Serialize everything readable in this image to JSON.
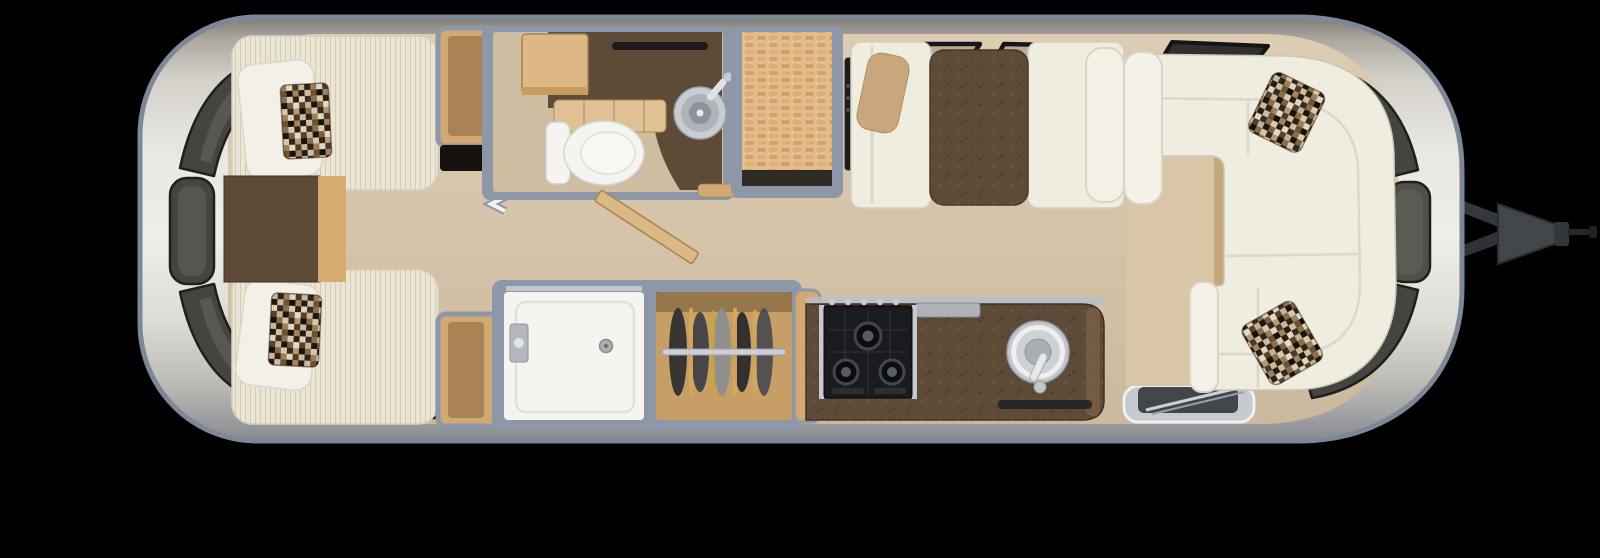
{
  "scene": {
    "type": "travel-trailer-floor-plan-top-view",
    "hitch_side": "right",
    "background": "#000000"
  },
  "palette": {
    "background": "#000000",
    "shell_outline": "#7d8798",
    "shell_metal_light": "#efeeea",
    "shell_metal_mid": "#c9c7c1",
    "shell_metal_dark": "#878a90",
    "interior_wall": "#8d97a7",
    "floor_main": "#d5c4a9",
    "floor_bath": "#cfbda2",
    "floor_lounge": "#d9c6a7",
    "dark_walnut": "#5e4b37",
    "wood_light": "#dcb886",
    "wood_counter": "#e0c193",
    "wood_mid": "#d2a873",
    "closet_wood": "#c79e66",
    "wicker_tan": "#e5bd8d",
    "mattress": "#ebe6d4",
    "upholstery_white": "#efece0",
    "pillow_white": "#f3f0e7",
    "pillow_tan": "#c9a77d",
    "porcelain": "#f4f4f0",
    "appliance_black": "#1a1b1e",
    "steel": "#c3c7cc",
    "window_dark": "#454440",
    "window_glass": "#6c6a62",
    "hitch_gray": "#42464a",
    "mosaic_dark": "#241b12",
    "mosaic_light": "#e0d4bf"
  },
  "floorplan": {
    "rooms": [
      {
        "id": "rear-bedroom",
        "furniture": [
          "twin-bed-roadside",
          "twin-bed-curbside",
          "white-pillows",
          "mosaic-accent-pillows",
          "nightstand",
          "foot-cabinet-roadside",
          "foot-cabinet-curbside",
          "bedroom-tv",
          "accordion-divider"
        ]
      },
      {
        "id": "bathroom",
        "furniture": [
          "toilet",
          "round-sink",
          "vanity-counter",
          "overhead-cabinet",
          "swing-door",
          "window"
        ]
      },
      {
        "id": "pantry",
        "furniture": [
          "wicker-shelf-top",
          "dark-sill"
        ]
      },
      {
        "id": "shower-room",
        "furniture": [
          "shower-pan",
          "shower-valve",
          "drain",
          "glass-edge"
        ]
      },
      {
        "id": "closet",
        "furniture": [
          "hanging-rod",
          "clothes-on-hangers"
        ]
      },
      {
        "id": "dinette",
        "furniture": [
          "bench-left",
          "bench-right",
          "dinette-table",
          "wall-tv",
          "tan-lumbar-pillow",
          "overhead-windows"
        ]
      },
      {
        "id": "kitchen",
        "furniture": [
          "three-burner-cooktop",
          "round-kitchen-sink",
          "dark-counter",
          "steel-trim",
          "floor-mat"
        ]
      },
      {
        "id": "entry",
        "furniture": [
          "entry-step"
        ]
      },
      {
        "id": "front-lounge",
        "furniture": [
          "wraparound-sofa",
          "mosaic-accent-pillow-top",
          "mosaic-accent-pillow-bottom"
        ]
      },
      {
        "id": "exterior",
        "furniture": [
          "hitch-a-frame",
          "coupler",
          "wraparound-windows"
        ]
      }
    ]
  }
}
